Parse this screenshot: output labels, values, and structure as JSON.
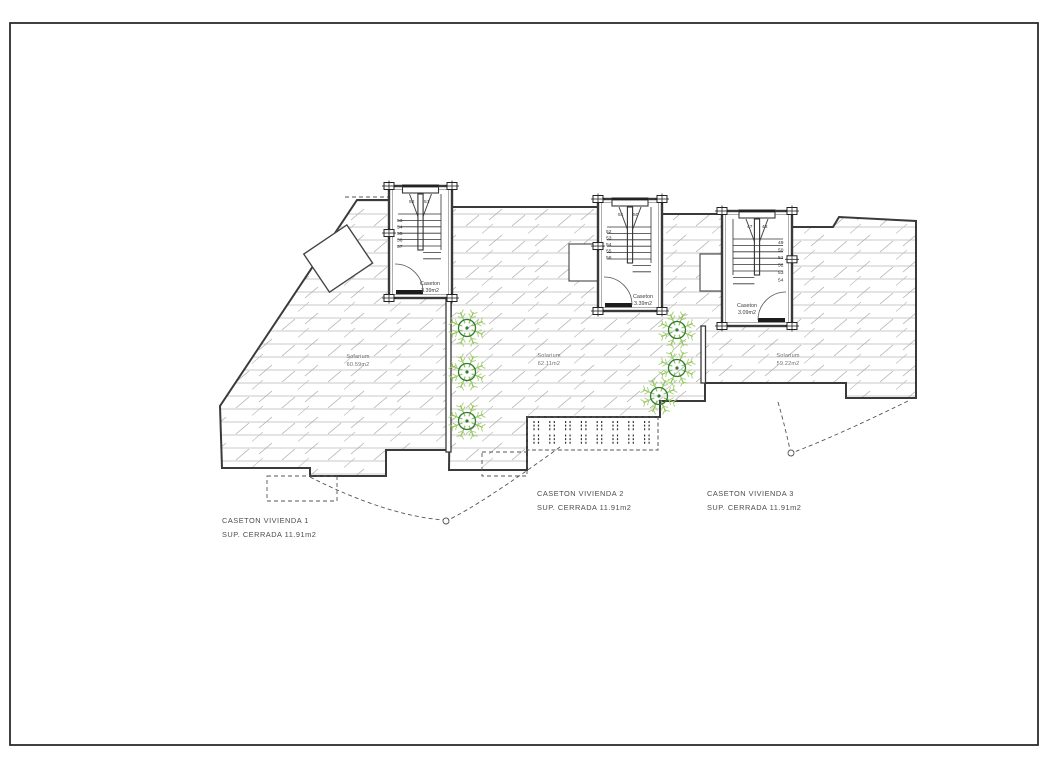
{
  "drawing": {
    "stairs": [
      {
        "caseton_label": "Caseton",
        "caseton_area": "3.39m2",
        "top_numbers": [
          "52",
          "51"
        ],
        "side_numbers": [
          "53",
          "54",
          "55",
          "56",
          "57"
        ]
      },
      {
        "caseton_label": "Caseton",
        "caseton_area": "3.39m2",
        "top_numbers": [
          "51",
          "50"
        ],
        "side_numbers": [
          "52",
          "53",
          "54",
          "55",
          "56"
        ]
      },
      {
        "caseton_label": "Caseton",
        "caseton_area": "3.09m2",
        "top_numbers": [
          "47",
          "48"
        ],
        "side_numbers": [
          "49",
          "50",
          "51",
          "52",
          "53",
          "54"
        ]
      }
    ],
    "solariums": [
      {
        "name": "Solarium",
        "area": "60.59m2"
      },
      {
        "name": "Solarium",
        "area": "62.11m2"
      },
      {
        "name": "Solarium",
        "area": "59.22m2"
      }
    ],
    "units": [
      {
        "title": "CASETON  VIVIENDA 1",
        "subtitle": "SUP. CERRADA  11.91m2"
      },
      {
        "title": "CASETON  VIVIENDA 2",
        "subtitle": "SUP. CERRADA  11.91m2"
      },
      {
        "title": "CASETON  VIVIENDA 3",
        "subtitle": "SUP. CERRADA  11.91m2"
      }
    ],
    "colors": {
      "wall": "#3a3a3a",
      "hatch": "#b6b6b6",
      "plant_leaf": "#8cbf4f",
      "plant_trunk": "#2f7d32"
    }
  }
}
